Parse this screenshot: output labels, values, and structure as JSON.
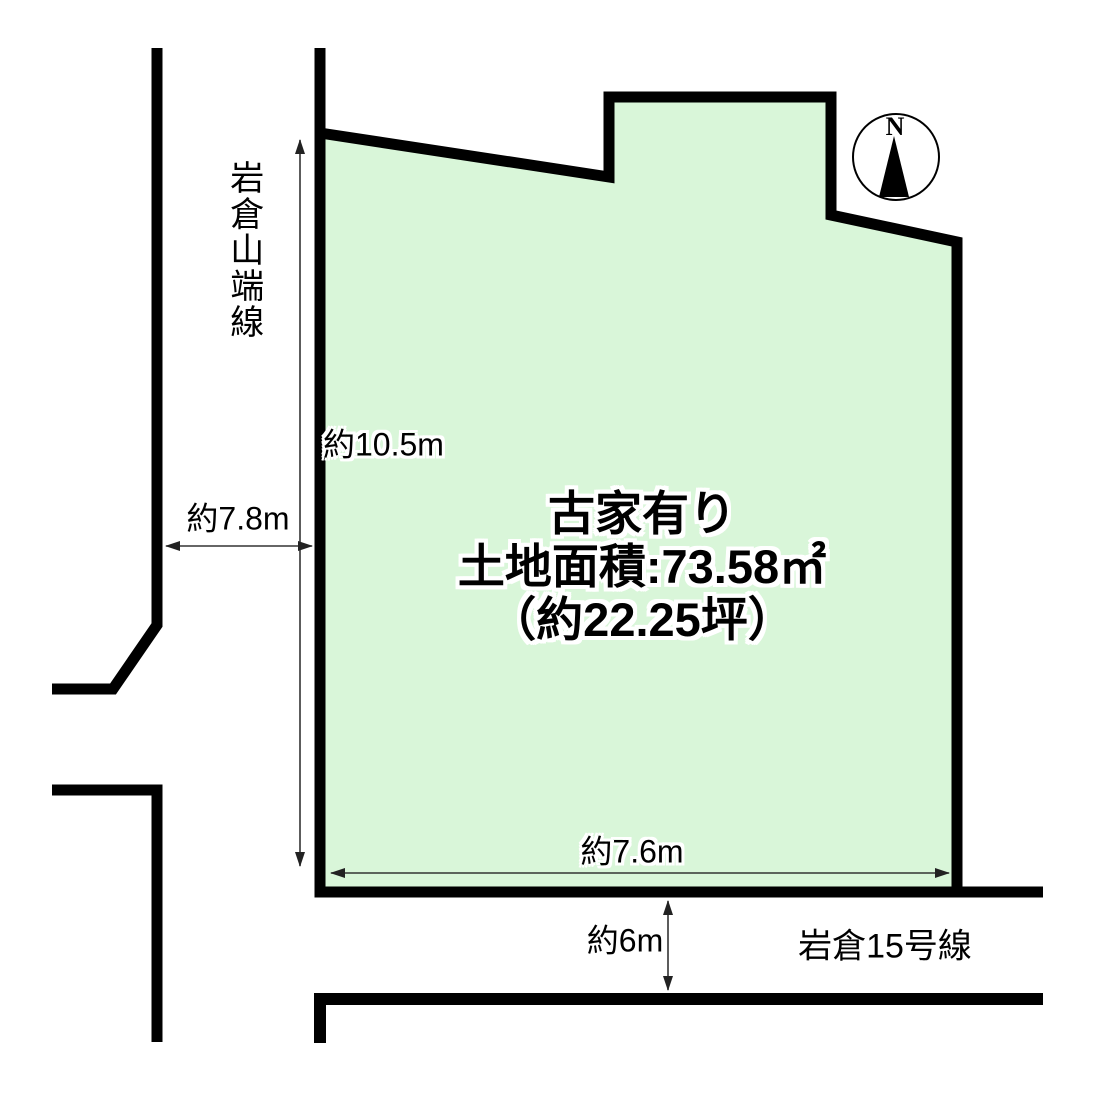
{
  "title_block": {
    "line1": "古家有り",
    "line2": "土地面積:73.58㎡",
    "line3": "（約22.25坪）"
  },
  "roads": {
    "west_road_name": "岩倉山端線",
    "south_road_name": "岩倉15号線"
  },
  "dimensions": {
    "west_frontage": "約10.5m",
    "west_road_width": "約7.8m",
    "south_frontage": "約7.6m",
    "south_road_width": "約6m"
  },
  "compass": {
    "north_label": "N"
  },
  "colors": {
    "parcel_fill": "#d9f6d9",
    "outline": "#000000",
    "arrow": "#333333"
  }
}
